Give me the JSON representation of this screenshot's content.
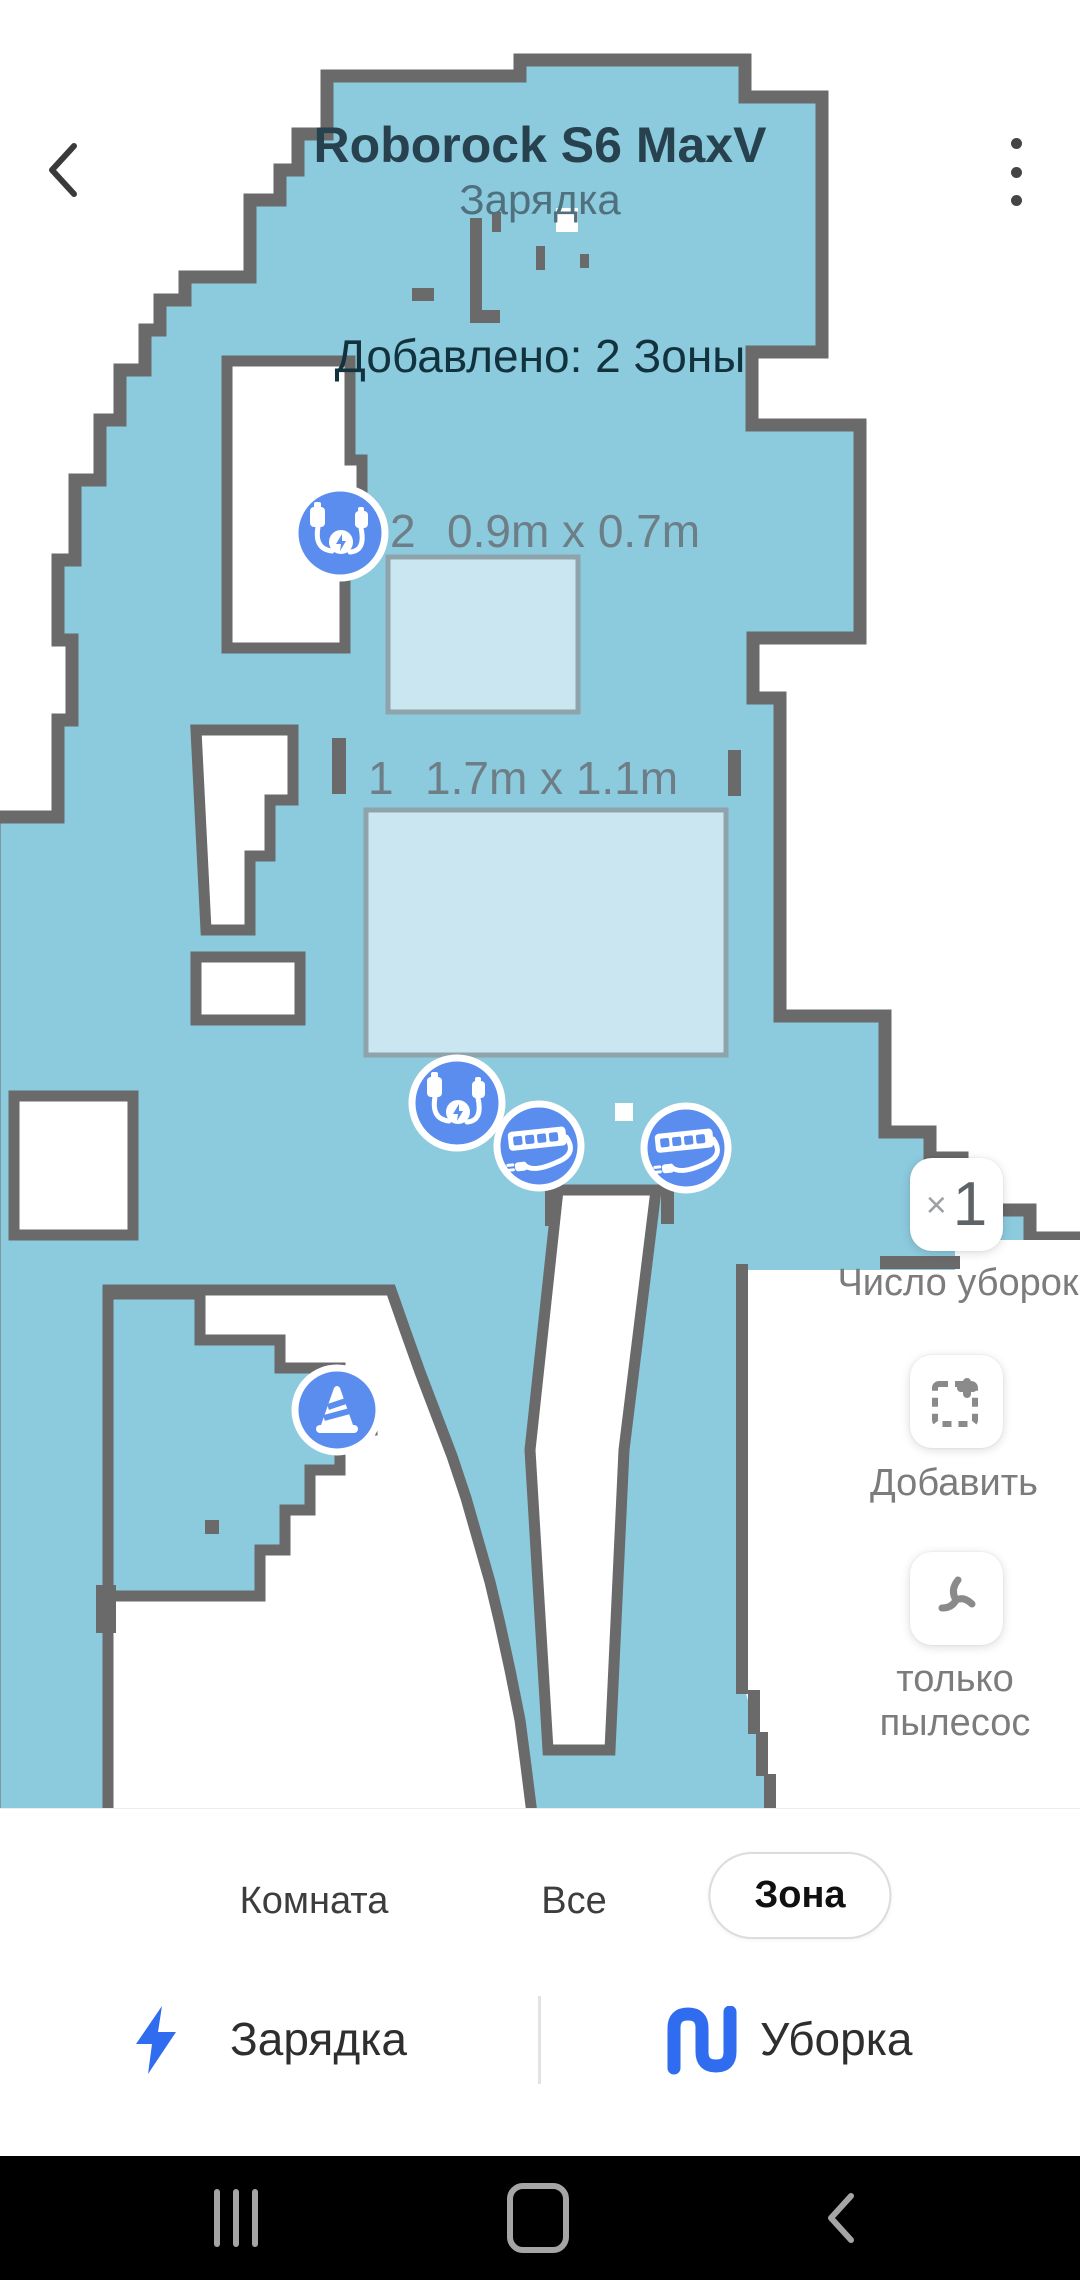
{
  "header": {
    "title": "Roborock S6 MaxV",
    "subtitle": "Зарядка",
    "status_note": "Добавлено: 2 Зоны"
  },
  "map": {
    "zones": [
      {
        "id": "2",
        "size": "0.9m x 0.7m"
      },
      {
        "id": "1",
        "size": "1.7m x 1.1m"
      }
    ],
    "markers": [
      "charging-cable-obstacle",
      "charging-cable-obstacle",
      "power-strip-obstacle",
      "power-strip-obstacle",
      "cone-obstacle"
    ],
    "colors": {
      "floor": "#8ccadd",
      "wall": "#6a6a6a",
      "zone_fill": "#cfe9f2",
      "marker_blue": "#5b8def"
    }
  },
  "side_controls": {
    "clean_count": {
      "prefix": "×",
      "value": "1",
      "label": "Число уборок"
    },
    "add_zone": {
      "label": "Добавить"
    },
    "vacuum_only": {
      "label_line1": "только",
      "label_line2": "пылесос"
    }
  },
  "bottom_sheet": {
    "tabs": [
      {
        "label": "Комната",
        "active": false
      },
      {
        "label": "Все",
        "active": false
      },
      {
        "label": "Зона",
        "active": true
      }
    ],
    "actions": [
      {
        "label": "Зарядка"
      },
      {
        "label": "Уборка"
      }
    ],
    "accent_color": "#2f6cf0"
  },
  "nav_bar": {
    "icons": [
      "recent-apps-icon",
      "home-icon",
      "back-icon"
    ]
  }
}
